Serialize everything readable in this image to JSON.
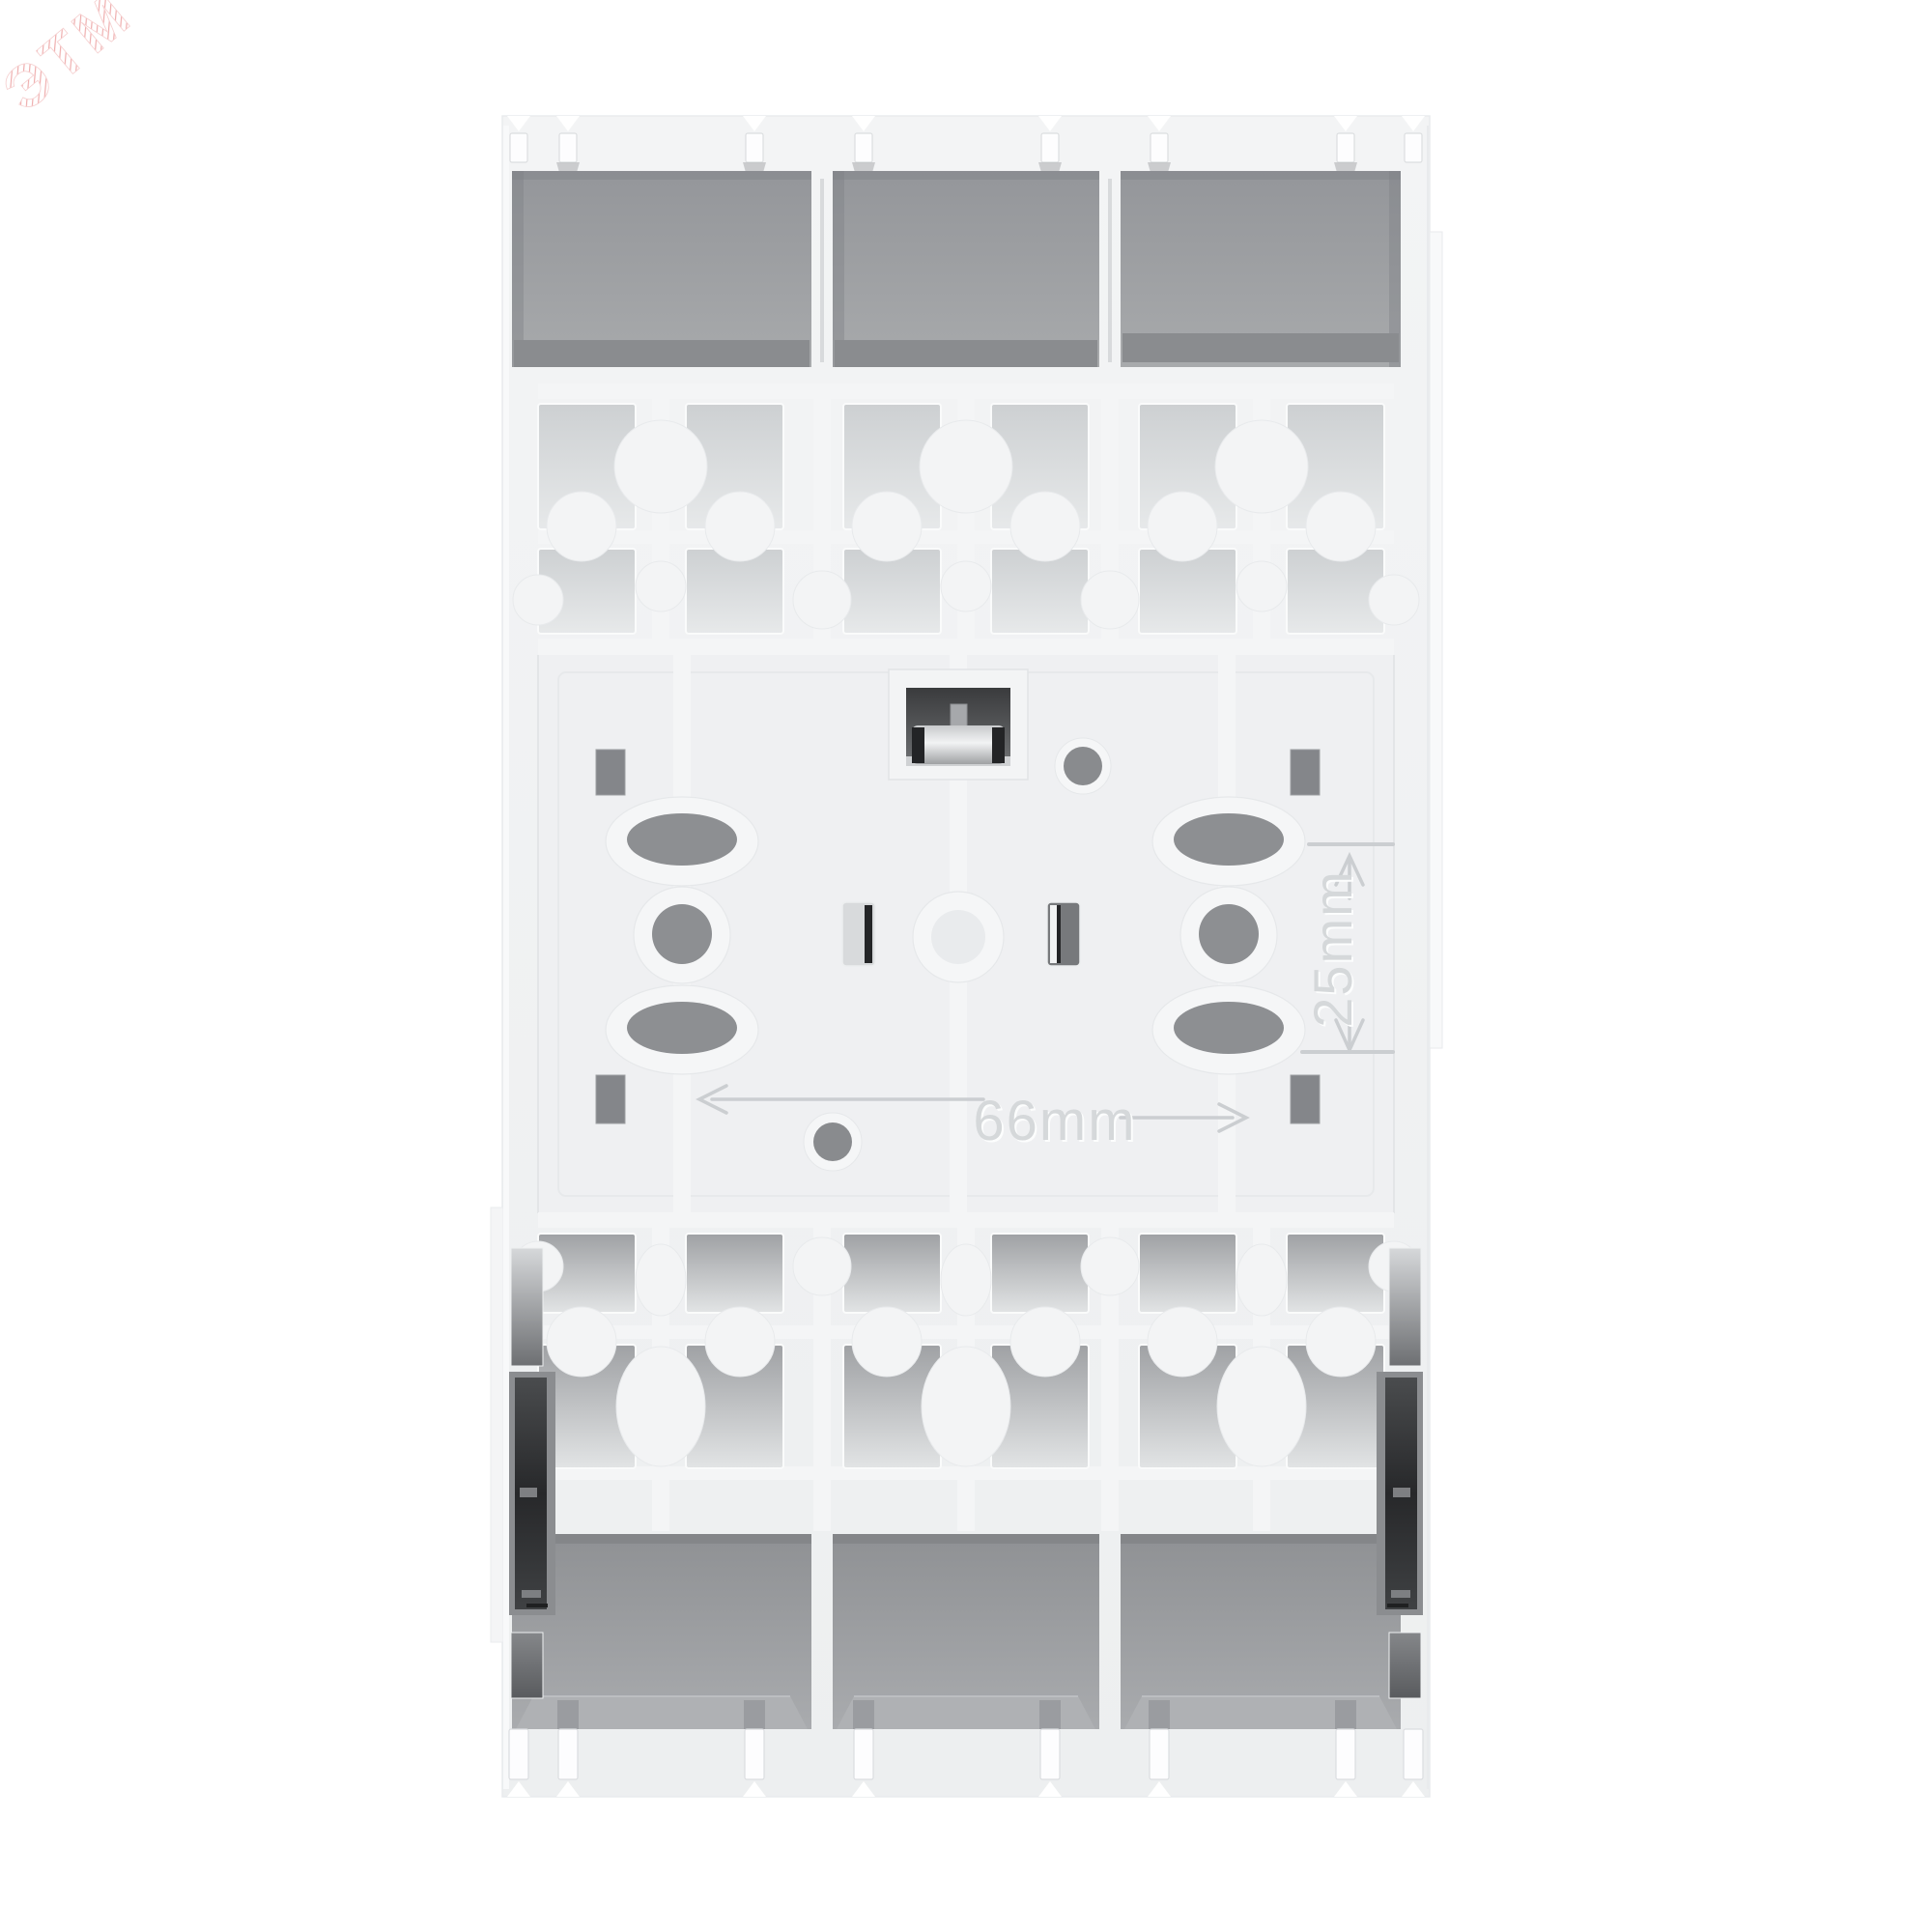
{
  "image": {
    "kind": "product-photo",
    "subject": "Rear view of a white 3-module DIN-rail electrical device showing terminal compartments and mounting plate",
    "background_color": "#ffffff"
  },
  "watermark": {
    "text": "ЭТМ",
    "color": "#ec9f9f"
  },
  "dimensions": {
    "horizontal": "66mm",
    "vertical": "25mm"
  },
  "palette": {
    "body": "#f2f3f4",
    "compartment_gray": "#9b9da0",
    "recess_gray": "#d7d9db",
    "slot_gray": "#85878a",
    "din_window_dark": "#3a3b3d",
    "embossed_line": "#cbced1",
    "watermark_red": "#ec9f9f"
  }
}
